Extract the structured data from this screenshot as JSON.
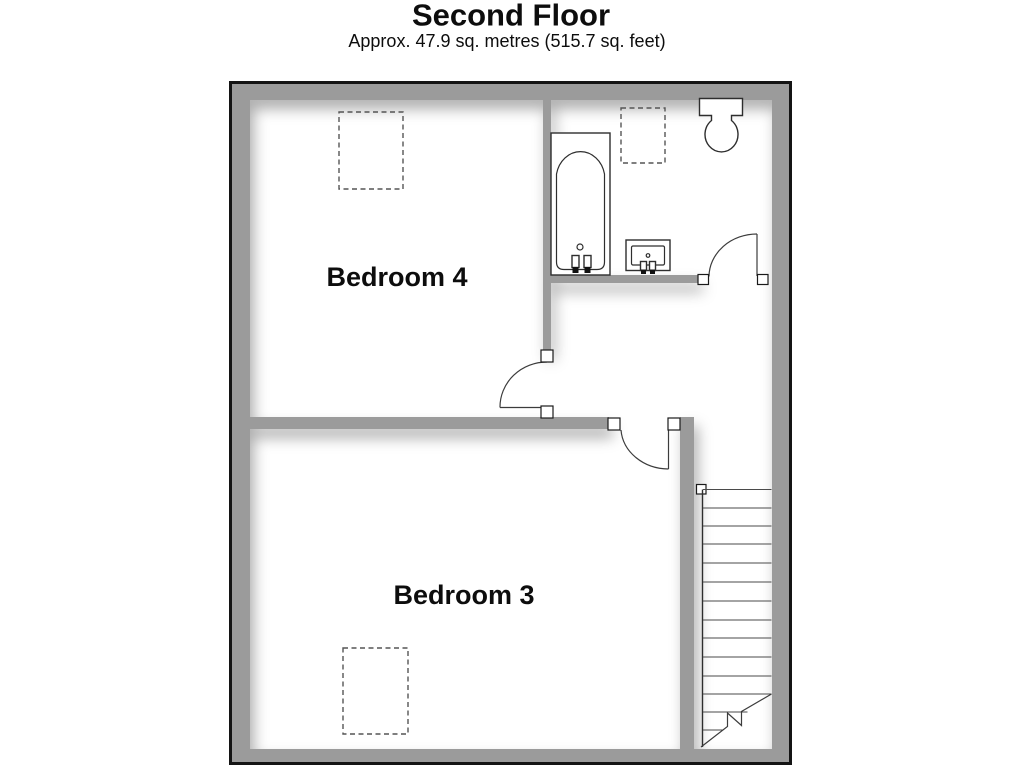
{
  "title": "Second Floor",
  "subtitle": "Approx. 47.9 sq. metres (515.7 sq. feet)",
  "rooms": {
    "bedroom4": {
      "label": "Bedroom 4"
    },
    "bedroom3": {
      "label": "Bedroom 3"
    }
  },
  "stairs": {
    "tread_count": 13
  },
  "colors": {
    "wall": "#9b9b9b",
    "outline": "#141414",
    "text": "#0d0d0d"
  }
}
